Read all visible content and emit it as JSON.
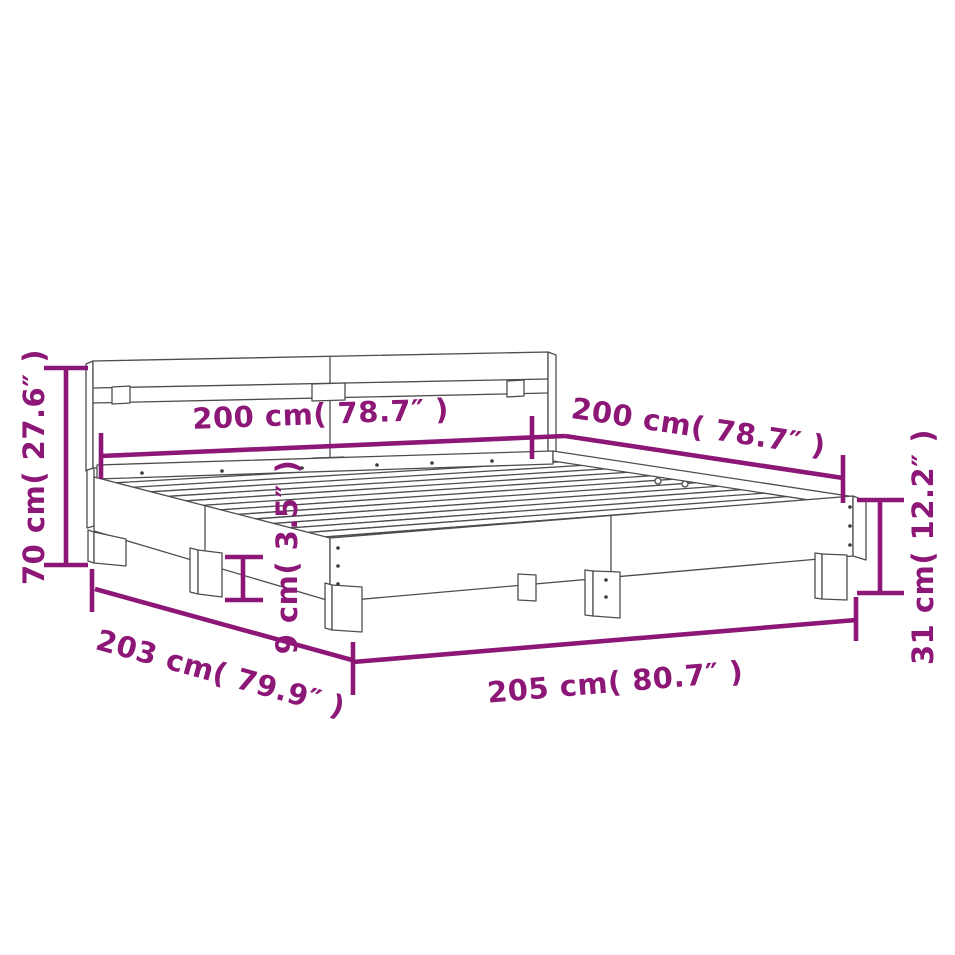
{
  "figure": {
    "type": "product dimension diagram",
    "subject": "bed frame with headboard and slatted base, isometric line drawing"
  },
  "colors": {
    "dimension_annotation": "#8d1777",
    "line_art": "#4d4d4d",
    "background": "#ffffff"
  },
  "dims": {
    "total_height": {
      "label": "70 cm( 27.6″ )",
      "value_cm": 70,
      "value_in": 27.6
    },
    "headboard_width": {
      "label": "200 cm( 78.7″ )",
      "value_cm": 200,
      "value_in": 78.7
    },
    "side_length": {
      "label": "200 cm( 78.7″ )",
      "value_cm": 200,
      "value_in": 78.7
    },
    "frame_width": {
      "label": "203 cm( 79.9″ )",
      "value_cm": 203,
      "value_in": 79.9
    },
    "frame_length": {
      "label": "205 cm( 80.7″ )",
      "value_cm": 205,
      "value_in": 80.7
    },
    "rail_height": {
      "label": "31 cm( 12.2″ )",
      "value_cm": 31,
      "value_in": 12.2
    },
    "plinth_height": {
      "label": "9 cm( 3.5″ )",
      "value_cm": 9,
      "value_in": 3.5
    }
  }
}
